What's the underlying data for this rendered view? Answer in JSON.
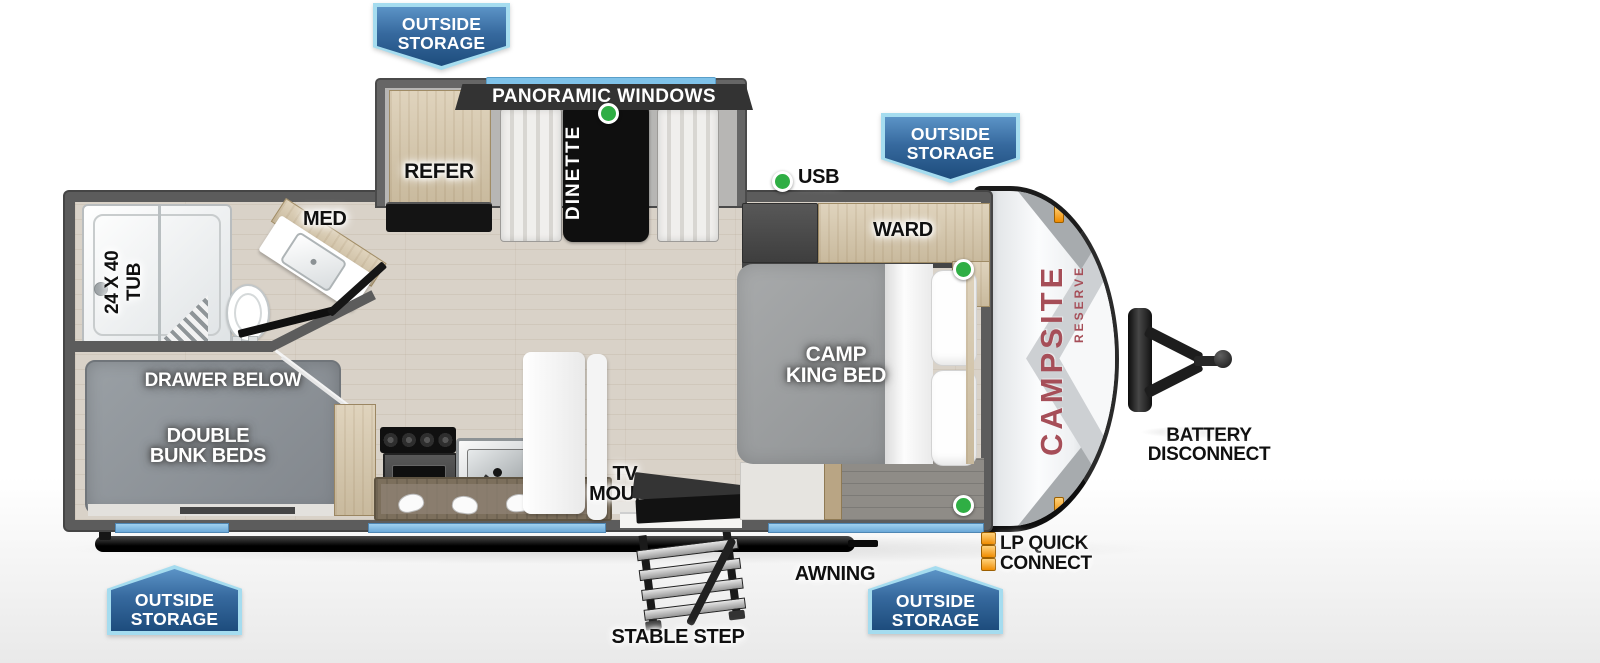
{
  "outside_storage": {
    "line1": "OUTSIDE",
    "line2": "STORAGE"
  },
  "labels": {
    "panoramic_windows": "PANORAMIC WINDOWS",
    "refer": "REFER",
    "dinette": "DINETTE",
    "usb": "USB",
    "ward": "WARD",
    "camp_king_bed": {
      "line1": "CAMP",
      "line2": "KING BED"
    },
    "med": "MED",
    "tub": {
      "line1": "24 X 40",
      "line2": "TUB"
    },
    "drawer_below": "DRAWER BELOW",
    "double_bunk_beds": {
      "line1": "DOUBLE",
      "line2": "BUNK BEDS"
    },
    "tv_mount": {
      "line1": "TV",
      "line2": "MOUNT"
    },
    "awning": "AWNING",
    "stable_step": "STABLE STEP",
    "lp_quick_connect": {
      "line1": "LP QUICK",
      "line2": "CONNECT"
    },
    "battery_disconnect": {
      "line1": "BATTERY",
      "line2": "DISCONNECT"
    }
  },
  "branding": {
    "model": "CAMPSITE",
    "series": "RESERVE"
  },
  "colors": {
    "banner_blue_top": "#5b93c6",
    "banner_blue_bottom": "#1d4c7c",
    "banner_border": "#a5dcef",
    "accent_green": "#2fae44",
    "window_blue": "#7fc2e9",
    "brand_red": "#a64e58",
    "clearance_orange": "#f08c00",
    "wall_gray": "#5c5c5c"
  }
}
